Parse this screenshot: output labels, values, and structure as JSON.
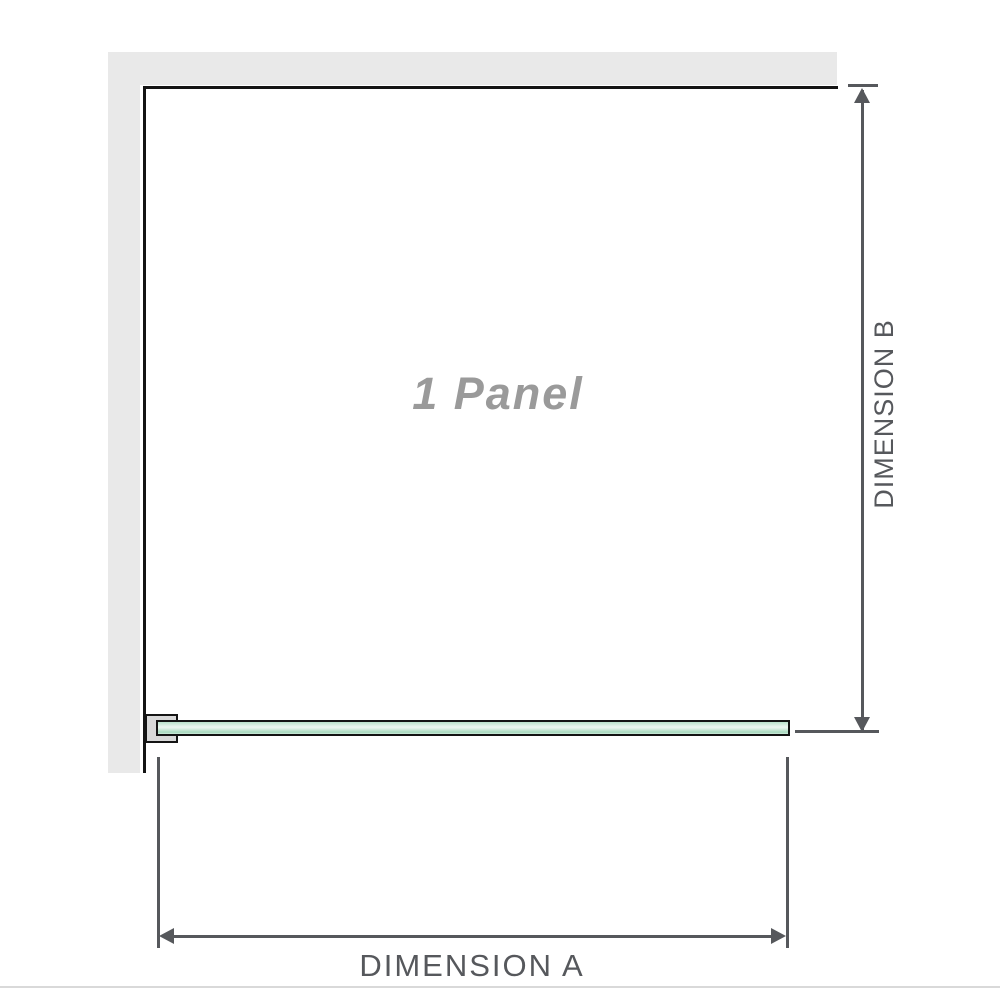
{
  "diagram": {
    "type": "shower-screen-dimension-diagram",
    "panel_label": "1 Panel",
    "dimension_a_label": "DIMENSION A",
    "dimension_b_label": "DIMENSION B",
    "icons": {
      "dimension_a": "double-headed-horizontal-arrow",
      "dimension_b": "double-headed-vertical-arrow"
    },
    "colors": {
      "wall": "#e9e9e9",
      "wall_edge": "#141414",
      "bracket_fill": "#d8d8d8",
      "glass_top": "#b9e1cb",
      "glass_mid": "#e9f5ee",
      "glass_bottom": "#a8d9be",
      "dimension": "#56585c",
      "panel_text": "#9a9a9a",
      "baseline": "#d9d9d9"
    }
  }
}
